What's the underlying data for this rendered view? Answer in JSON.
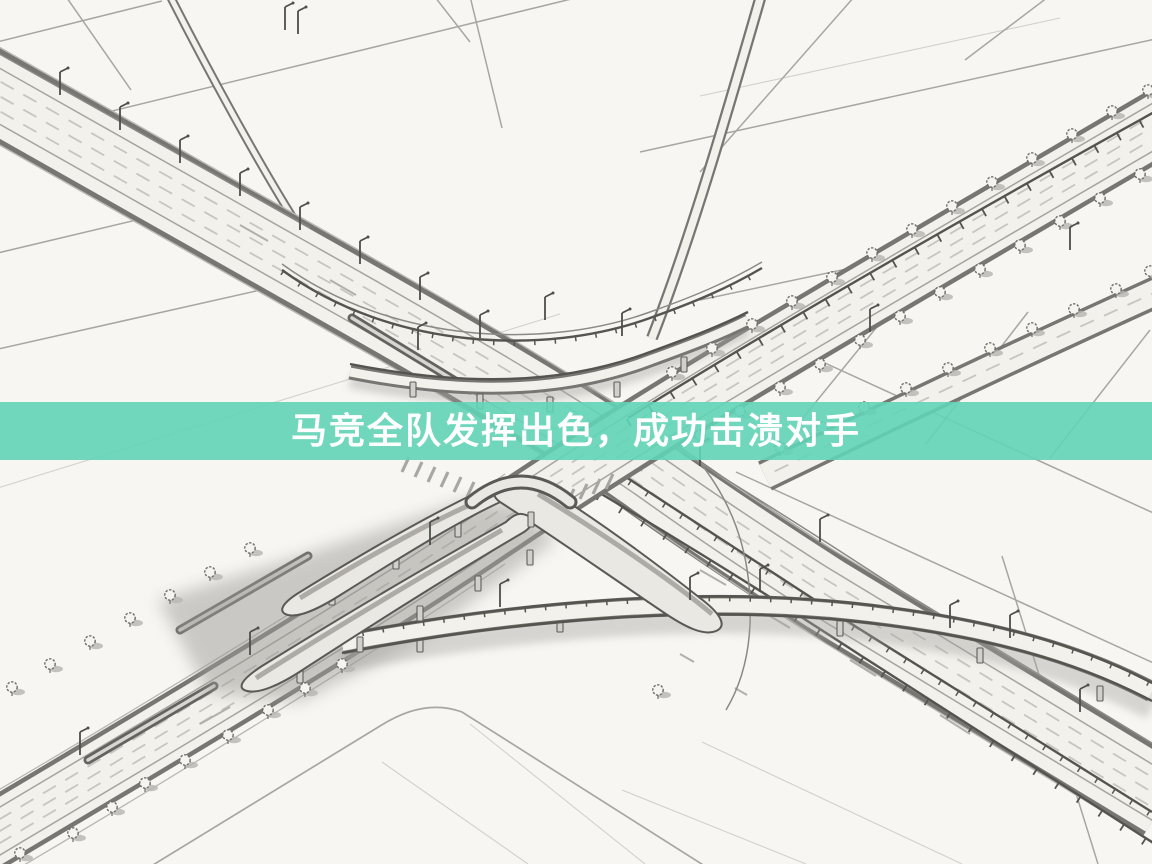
{
  "banner": {
    "text": "马竞全队发挥出色，成功击溃对手",
    "background_color": "#61D4B7",
    "text_color": "#FFFFFF"
  },
  "illustration": {
    "description": "Black-and-white pencil-style aerial sketch of a large highway interchange: two tree-lined expressways crossing diagonally, elevated curved ramps on pillars with soft cast shadows, zebra crossings near the center, and empty rounded-corner fields all around",
    "paper_color": "#f8f6f2",
    "ink_color": "#55544f",
    "shadow_color": "#8d8b86"
  }
}
